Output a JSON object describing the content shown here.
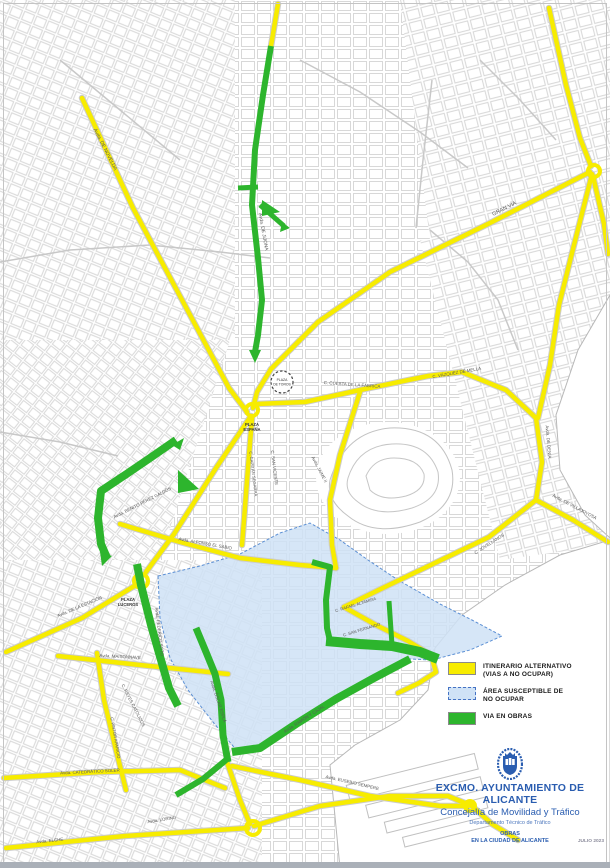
{
  "legend": {
    "items": [
      {
        "key": "itinerario-alternativo",
        "swatch_color": "#f7ec00",
        "swatch_style": "solid",
        "label": "ITINERARIO ALTERNATIVO\n(VIAS A NO OCUPAR)"
      },
      {
        "key": "area-susceptible",
        "swatch_color": "#cfe2f6",
        "swatch_style": "dashed",
        "label": "ÁREA SUSCEPTIBLE DE\nNO OCUPAR"
      },
      {
        "key": "via-en-obras",
        "swatch_color": "#2db52d",
        "swatch_style": "solid",
        "label": "VIA EN OBRAS"
      }
    ]
  },
  "title_block": {
    "org": "EXCMO. AYUNTAMIENTO DE ALICANTE",
    "department": "Concejalía de Movilidad y Tráfico",
    "sub_department": "Departamento Técnico de Tráfico",
    "doc_title": "OBRAS\nEN LA CIUDAD DE ALICANTE",
    "date": "JULIO 2023",
    "accent_color": "#2a5db0"
  },
  "map": {
    "colors": {
      "yellow": "#f7ec00",
      "yellow_casing": "#cccccc",
      "green": "#2db52d",
      "area_fill": "#cfe2f6",
      "area_border": "#5b8fd4",
      "base_street": "#d2d2d2",
      "label": "#5a5a5a"
    },
    "plazas": {
      "plaza_de_toros": {
        "cx": 282,
        "cy": 382,
        "r": 11,
        "line1": "PLAZA",
        "line2": "DE TOROS"
      },
      "labels": [
        {
          "t": "PLAZA",
          "x": 252,
          "y": 426,
          "r": 0,
          "s": 4.2
        },
        {
          "t": "ESPAÑA",
          "x": 252,
          "y": 431,
          "r": 0,
          "s": 4.2
        },
        {
          "t": "PLAZA",
          "x": 128,
          "y": 601,
          "r": 0,
          "s": 4.2
        },
        {
          "t": "LUCEROS",
          "x": 128,
          "y": 606,
          "r": 0,
          "s": 4.2
        }
      ]
    },
    "street_labels": [
      {
        "t": "Avda. DE NOVELDA",
        "x": 104,
        "y": 150,
        "r": 63,
        "s": 5
      },
      {
        "t": "GRAN VÍA",
        "x": 505,
        "y": 210,
        "r": -27,
        "s": 5.5
      },
      {
        "t": "Avda. DE JIJONA",
        "x": 262,
        "y": 232,
        "r": 80,
        "s": 4.8
      },
      {
        "t": "C. CUESTA DE LA FÁBRICA",
        "x": 352,
        "y": 386,
        "r": 4,
        "s": 4.4
      },
      {
        "t": "C. VÁZQUEZ DE MELLA",
        "x": 457,
        "y": 374,
        "r": -10,
        "s": 4.4
      },
      {
        "t": "Avda. DE DENIA",
        "x": 547,
        "y": 442,
        "r": 85,
        "s": 4.4
      },
      {
        "t": "Avda. DE VILLAJOYOSA",
        "x": 574,
        "y": 508,
        "r": 28,
        "s": 4.4
      },
      {
        "t": "C. JOVELLANOS",
        "x": 490,
        "y": 545,
        "r": -33,
        "s": 4.4
      },
      {
        "t": "C. SAN VICENTE",
        "x": 273,
        "y": 468,
        "r": 83,
        "s": 4.4
      },
      {
        "t": "C. CAPITÁN SEGARRA",
        "x": 252,
        "y": 474,
        "r": 83,
        "s": 4.2
      },
      {
        "t": "Avda. JAIME II",
        "x": 318,
        "y": 470,
        "r": 62,
        "s": 4.4
      },
      {
        "t": "Avda. BENITO PÉREZ GALDÓS",
        "x": 143,
        "y": 504,
        "r": -27,
        "s": 4.4
      },
      {
        "t": "Avda. ALFONSO EL SABIO",
        "x": 205,
        "y": 545,
        "r": 10,
        "s": 4.4
      },
      {
        "t": "Avda. DE LA ESTACIÓN",
        "x": 80,
        "y": 608,
        "r": -23,
        "s": 4.4
      },
      {
        "t": "Avda. FEDERICO SOTO",
        "x": 158,
        "y": 632,
        "r": 83,
        "s": 4.4
      },
      {
        "t": "Avda. MAISONNAVE",
        "x": 120,
        "y": 658,
        "r": 3,
        "s": 4.4
      },
      {
        "t": "C. REYES CATÓLICOS",
        "x": 132,
        "y": 706,
        "r": 63,
        "s": 4.4
      },
      {
        "t": "C. PINTOR APARICIO",
        "x": 114,
        "y": 738,
        "r": 80,
        "s": 4.2
      },
      {
        "t": "Avda. ÓSCAR ESPLÁ",
        "x": 217,
        "y": 702,
        "r": 72,
        "s": 4.4
      },
      {
        "t": "Avda. RAMÓN Y CAJAL",
        "x": 305,
        "y": 720,
        "r": -33,
        "s": 4.4
      },
      {
        "t": "C. SAN FERNANDO",
        "x": 362,
        "y": 631,
        "r": -17,
        "s": 4.2
      },
      {
        "t": "C. RAFAEL ALTAMIRA",
        "x": 356,
        "y": 606,
        "r": -17,
        "s": 4.2
      },
      {
        "t": "Avda. CATEDRÁTICO SOLER",
        "x": 90,
        "y": 773,
        "r": -3,
        "s": 4.4
      },
      {
        "t": "Avda. EUSEBIO SEMPERE",
        "x": 352,
        "y": 784,
        "r": 13,
        "s": 4.4
      },
      {
        "t": "Avda. ELCHE",
        "x": 50,
        "y": 842,
        "r": -6,
        "s": 4.4
      },
      {
        "t": "Avda. LORING",
        "x": 162,
        "y": 821,
        "r": -9,
        "s": 4.4
      }
    ],
    "blue_area": {
      "path": "M158,576 L200,566 L240,554 L280,533 L310,523 L340,540 L368,560 L398,580 L440,604 L472,620 L502,636 L470,650 L432,660 L410,659 L374,678 L336,699 L296,724 L262,748 L238,752 L213,722 L188,690 L170,658 L160,618 Z"
    },
    "yellow_routes": [
      "M278,4 L271,46",
      "M82,98 L133,208 L181,298 L229,388 L247,412",
      "M549,8 L566,85 L580,138 L591,166",
      "M590,172 L492,222 L390,272 L318,322 L291,349",
      "M593,176 L604,224 L608,254",
      "M291,349 L271,369 L257,392 L253,408",
      "M256,404 L305,402 L360,390 L428,376 L462,372 L506,390 L536,418",
      "M536,418 L542,462 L536,500",
      "M536,500 L573,520 L608,542",
      "M536,500 L489,537 L437,562 L389,585 L344,607",
      "M344,607 L376,625 L408,641 L431,655 L436,672 L419,683 L398,693",
      "M251,416 L216,468 L174,534 L146,572",
      "M136,585 L82,618 L6,652",
      "M58,656 L140,665 L228,674",
      "M97,653 L104,700 L116,750 L126,790",
      "M4,778 L100,772 L180,770 L225,788",
      "M227,762 L240,800 L250,824",
      "M6,848 L125,836 L248,828",
      "M254,826 L320,806 L390,796 L448,796 L472,806 L492,824 L518,840",
      "M232,766 L300,780 L370,796 L440,806 L468,806",
      "M592,174 L574,245 L559,305 L550,365 L538,418",
      "M360,392 L340,455 L330,500 L332,545 L336,568",
      "M252,418 L248,468 L244,520 L242,545",
      "M120,524 L180,542 L240,558 L300,565 L336,568"
    ],
    "yellow_rings": [
      {
        "cx": 141,
        "cy": 581,
        "r": 7
      },
      {
        "cx": 252,
        "cy": 410,
        "r": 6
      },
      {
        "cx": 253,
        "cy": 828,
        "r": 7
      },
      {
        "cx": 594,
        "cy": 171,
        "r": 6
      },
      {
        "cx": 470,
        "cy": 806,
        "r": 5
      }
    ],
    "green_routes": [
      {
        "d": "M271,46 L263,95 L255,150 L252,205 L258,258 L262,300 L258,335 L255,352",
        "w": 6
      },
      {
        "d": "M258,187 L238,188",
        "w": 5
      },
      {
        "d": "M260,205 L284,226",
        "w": 5
      },
      {
        "d": "M176,440 L150,458 L128,473 L101,491 L98,518 L101,544 L107,558",
        "w": 8
      },
      {
        "d": "M137,564 L141,585 L151,625 L161,660 L169,688 L178,706",
        "w": 8
      },
      {
        "d": "M196,628 L206,652 L215,674 L221,700 L223,735 L228,762",
        "w": 7
      },
      {
        "d": "M226,760 L203,779 L176,795",
        "w": 6
      },
      {
        "d": "M232,752 L260,748 L296,724 L336,699 L374,678 L410,659",
        "w": 8
      },
      {
        "d": "M326,641 L360,644 L392,646 L420,652 L438,659",
        "w": 10
      },
      {
        "d": "M312,562 L330,567 L326,600 L327,628 L331,645",
        "w": 6
      },
      {
        "d": "M389,601 L392,645",
        "w": 5
      }
    ],
    "green_areas": [
      "249,350 261,350 255,363",
      "172,445 184,438 180,450",
      "178,470 199,489 178,493",
      "100,552 112,556 102,566",
      "282,222 290,228 280,232",
      "262,200 280,212 262,216"
    ],
    "gray_arterials": [
      "M0,262 L70,250 L150,245 L220,252 L270,258",
      "M300,60 L360,92 L420,132 L468,168",
      "M432,80 L423,160 L416,228",
      "M0,432 L60,442 L118,456",
      "M430,230 L468,262 L498,300 L518,350",
      "M60,60 L120,110 L180,160",
      "M480,60 L520,100 L556,140"
    ]
  }
}
